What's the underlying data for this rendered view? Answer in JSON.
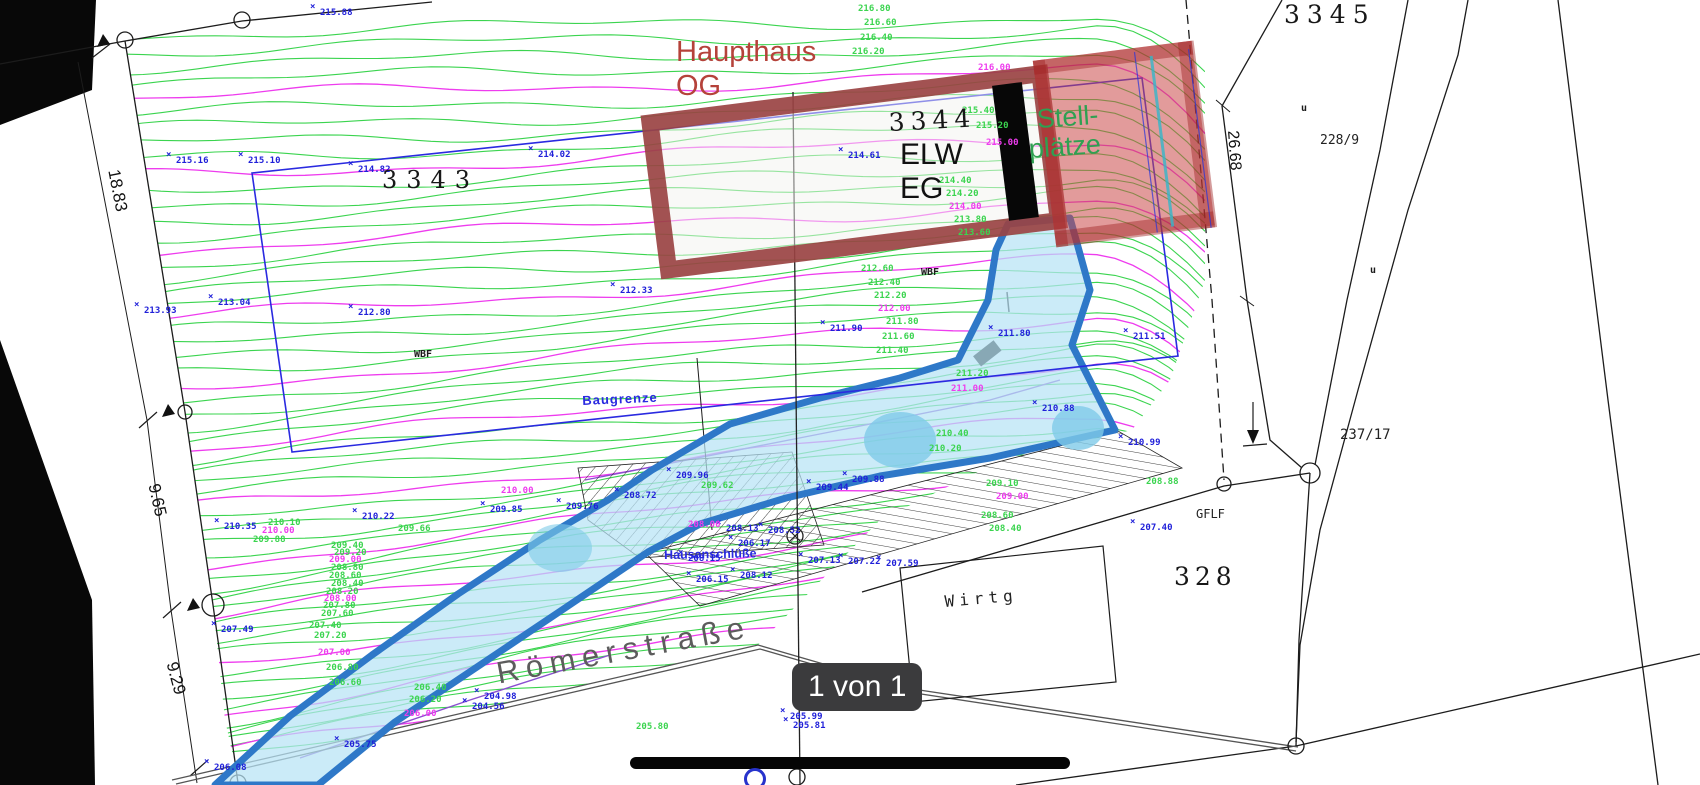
{
  "viewer": {
    "page_indicator": "1 von 1"
  },
  "annotations": {
    "haupthaus_line1": "Haupthaus",
    "haupthaus_line2": "OG",
    "parcel_3344": "3344",
    "elw": "ELW",
    "eg": "EG",
    "stell_line1": "Stell-",
    "stell_line2": "plätze"
  },
  "parcels": {
    "p3343": "3343",
    "p3345": "3345",
    "p328": "328",
    "p237_17": "237/17",
    "p228_9": "228/9"
  },
  "labels": {
    "baugrenze": "Baugrenze",
    "hausanschluesse": "Hausanschlüße",
    "roemerstrasse": "Römerstraße",
    "wirtg": "Wirtg",
    "gflf": "GFLF"
  },
  "dimensions": {
    "d18_83": "18.83",
    "d9_65": "9.65",
    "d9_29": "9.29",
    "d26_68": "26.68"
  },
  "colors": {
    "contour_green": "#3bd44f",
    "contour_magenta": "#ee3cee",
    "point_blue": "#1f1fd9",
    "building_red": "#9a4343",
    "overlay_red": "rgba(203,72,72,0.55)",
    "driveway_border": "#2e78c8",
    "driveway_fill": "#b7e3f5",
    "boundary_blue": "#2a2ae0",
    "text_red": "#b5423a",
    "text_green": "#2fa052",
    "badge_bg": "#3b3b3d"
  },
  "point_labels": [
    {
      "x": 320,
      "y": 8,
      "t": "215.88",
      "c": "blue"
    },
    {
      "x": 176,
      "y": 156,
      "t": "215.16",
      "c": "blue"
    },
    {
      "x": 248,
      "y": 156,
      "t": "215.10",
      "c": "blue"
    },
    {
      "x": 358,
      "y": 165,
      "t": "214.82",
      "c": "blue"
    },
    {
      "x": 538,
      "y": 150,
      "t": "214.02",
      "c": "blue"
    },
    {
      "x": 848,
      "y": 151,
      "t": "214.61",
      "c": "blue"
    },
    {
      "x": 144,
      "y": 306,
      "t": "213.93",
      "c": "blue"
    },
    {
      "x": 218,
      "y": 298,
      "t": "213.04",
      "c": "blue"
    },
    {
      "x": 358,
      "y": 308,
      "t": "212.80",
      "c": "blue"
    },
    {
      "x": 620,
      "y": 286,
      "t": "212.33",
      "c": "blue"
    },
    {
      "x": 830,
      "y": 324,
      "t": "211.90",
      "c": "blue"
    },
    {
      "x": 998,
      "y": 329,
      "t": "211.80",
      "c": "blue"
    },
    {
      "x": 1133,
      "y": 332,
      "t": "211.51",
      "c": "blue"
    },
    {
      "x": 1128,
      "y": 438,
      "t": "210.99",
      "c": "blue"
    },
    {
      "x": 1042,
      "y": 404,
      "t": "210.88",
      "c": "blue"
    },
    {
      "x": 224,
      "y": 522,
      "t": "210.35",
      "c": "blue"
    },
    {
      "x": 362,
      "y": 512,
      "t": "210.22",
      "c": "blue"
    },
    {
      "x": 490,
      "y": 505,
      "t": "209.85",
      "c": "blue"
    },
    {
      "x": 566,
      "y": 502,
      "t": "209.76",
      "c": "blue"
    },
    {
      "x": 676,
      "y": 471,
      "t": "209.96",
      "c": "blue"
    },
    {
      "x": 816,
      "y": 483,
      "t": "209.44",
      "c": "blue"
    },
    {
      "x": 852,
      "y": 475,
      "t": "209.88",
      "c": "blue"
    },
    {
      "x": 624,
      "y": 491,
      "t": "208.72",
      "c": "blue"
    },
    {
      "x": 726,
      "y": 524,
      "t": "208.13",
      "c": "blue"
    },
    {
      "x": 768,
      "y": 526,
      "t": "208.52",
      "c": "blue"
    },
    {
      "x": 688,
      "y": 554,
      "t": "208.15",
      "c": "blue"
    },
    {
      "x": 808,
      "y": 556,
      "t": "207.13",
      "c": "blue"
    },
    {
      "x": 848,
      "y": 557,
      "t": "207.22",
      "c": "blue"
    },
    {
      "x": 886,
      "y": 559,
      "t": "207.59",
      "c": "blue"
    },
    {
      "x": 738,
      "y": 539,
      "t": "206.17",
      "c": "blue"
    },
    {
      "x": 696,
      "y": 575,
      "t": "206.15",
      "c": "blue"
    },
    {
      "x": 740,
      "y": 571,
      "t": "208.12",
      "c": "blue"
    },
    {
      "x": 1140,
      "y": 523,
      "t": "207.40",
      "c": "blue"
    },
    {
      "x": 221,
      "y": 625,
      "t": "207.49",
      "c": "blue"
    },
    {
      "x": 214,
      "y": 763,
      "t": "206.08",
      "c": "blue"
    },
    {
      "x": 344,
      "y": 740,
      "t": "205.75",
      "c": "blue"
    },
    {
      "x": 790,
      "y": 712,
      "t": "205.99",
      "c": "blue"
    },
    {
      "x": 793,
      "y": 721,
      "t": "205.81",
      "c": "blue"
    },
    {
      "x": 484,
      "y": 692,
      "t": "204.98",
      "c": "blue"
    },
    {
      "x": 472,
      "y": 702,
      "t": "204.56",
      "c": "blue"
    },
    {
      "x": 858,
      "y": 4,
      "t": "216.80",
      "c": "green"
    },
    {
      "x": 864,
      "y": 18,
      "t": "216.60",
      "c": "green"
    },
    {
      "x": 860,
      "y": 33,
      "t": "216.40",
      "c": "green"
    },
    {
      "x": 852,
      "y": 47,
      "t": "216.20",
      "c": "green"
    },
    {
      "x": 978,
      "y": 63,
      "t": "216.00",
      "c": "magenta"
    },
    {
      "x": 962,
      "y": 106,
      "t": "215.40",
      "c": "green"
    },
    {
      "x": 976,
      "y": 121,
      "t": "215.20",
      "c": "green"
    },
    {
      "x": 986,
      "y": 138,
      "t": "215.00",
      "c": "magenta"
    },
    {
      "x": 939,
      "y": 176,
      "t": "214.40",
      "c": "green"
    },
    {
      "x": 946,
      "y": 189,
      "t": "214.20",
      "c": "green"
    },
    {
      "x": 949,
      "y": 202,
      "t": "214.00",
      "c": "magenta"
    },
    {
      "x": 954,
      "y": 215,
      "t": "213.80",
      "c": "green"
    },
    {
      "x": 958,
      "y": 228,
      "t": "213.60",
      "c": "green"
    },
    {
      "x": 861,
      "y": 264,
      "t": "212.60",
      "c": "green"
    },
    {
      "x": 868,
      "y": 278,
      "t": "212.40",
      "c": "green"
    },
    {
      "x": 874,
      "y": 291,
      "t": "212.20",
      "c": "green"
    },
    {
      "x": 878,
      "y": 304,
      "t": "212.00",
      "c": "magenta"
    },
    {
      "x": 886,
      "y": 317,
      "t": "211.80",
      "c": "green"
    },
    {
      "x": 882,
      "y": 332,
      "t": "211.60",
      "c": "green"
    },
    {
      "x": 876,
      "y": 346,
      "t": "211.40",
      "c": "green"
    },
    {
      "x": 956,
      "y": 369,
      "t": "211.20",
      "c": "green"
    },
    {
      "x": 951,
      "y": 384,
      "t": "211.00",
      "c": "magenta"
    },
    {
      "x": 936,
      "y": 429,
      "t": "210.40",
      "c": "green"
    },
    {
      "x": 929,
      "y": 444,
      "t": "210.20",
      "c": "green"
    },
    {
      "x": 501,
      "y": 486,
      "t": "210.00",
      "c": "magenta"
    },
    {
      "x": 268,
      "y": 518,
      "t": "210.10",
      "c": "green"
    },
    {
      "x": 262,
      "y": 526,
      "t": "210.00",
      "c": "magenta"
    },
    {
      "x": 253,
      "y": 535,
      "t": "209.88",
      "c": "green"
    },
    {
      "x": 398,
      "y": 524,
      "t": "209.66",
      "c": "green"
    },
    {
      "x": 701,
      "y": 481,
      "t": "209.62",
      "c": "green"
    },
    {
      "x": 986,
      "y": 479,
      "t": "209.10",
      "c": "green"
    },
    {
      "x": 996,
      "y": 492,
      "t": "209.00",
      "c": "magenta"
    },
    {
      "x": 981,
      "y": 511,
      "t": "208.60",
      "c": "green"
    },
    {
      "x": 989,
      "y": 524,
      "t": "208.40",
      "c": "green"
    },
    {
      "x": 1146,
      "y": 477,
      "t": "208.88",
      "c": "green"
    },
    {
      "x": 688,
      "y": 520,
      "t": "208.00",
      "c": "magenta"
    },
    {
      "x": 331,
      "y": 541,
      "t": "209.40",
      "c": "green"
    },
    {
      "x": 334,
      "y": 548,
      "t": "209.20",
      "c": "green"
    },
    {
      "x": 329,
      "y": 555,
      "t": "209.00",
      "c": "magenta"
    },
    {
      "x": 331,
      "y": 563,
      "t": "208.80",
      "c": "green"
    },
    {
      "x": 329,
      "y": 571,
      "t": "208.60",
      "c": "green"
    },
    {
      "x": 331,
      "y": 579,
      "t": "208.40",
      "c": "green"
    },
    {
      "x": 326,
      "y": 587,
      "t": "208.20",
      "c": "green"
    },
    {
      "x": 324,
      "y": 594,
      "t": "208.00",
      "c": "magenta"
    },
    {
      "x": 323,
      "y": 601,
      "t": "207.80",
      "c": "green"
    },
    {
      "x": 321,
      "y": 609,
      "t": "207.60",
      "c": "green"
    },
    {
      "x": 309,
      "y": 621,
      "t": "207.40",
      "c": "green"
    },
    {
      "x": 314,
      "y": 631,
      "t": "207.20",
      "c": "green"
    },
    {
      "x": 318,
      "y": 648,
      "t": "207.00",
      "c": "magenta"
    },
    {
      "x": 326,
      "y": 663,
      "t": "206.80",
      "c": "green"
    },
    {
      "x": 329,
      "y": 678,
      "t": "206.60",
      "c": "green"
    },
    {
      "x": 414,
      "y": 683,
      "t": "206.40",
      "c": "green"
    },
    {
      "x": 409,
      "y": 695,
      "t": "206.20",
      "c": "green"
    },
    {
      "x": 404,
      "y": 709,
      "t": "206.00",
      "c": "magenta"
    },
    {
      "x": 636,
      "y": 722,
      "t": "205.80",
      "c": "green"
    },
    {
      "x": 414,
      "y": 350,
      "t": "WBF",
      "c": "black"
    },
    {
      "x": 921,
      "y": 268,
      "t": "WBF",
      "c": "black"
    },
    {
      "x": 1301,
      "y": 104,
      "t": "u",
      "c": "black"
    },
    {
      "x": 1370,
      "y": 266,
      "t": "u",
      "c": "black"
    }
  ]
}
